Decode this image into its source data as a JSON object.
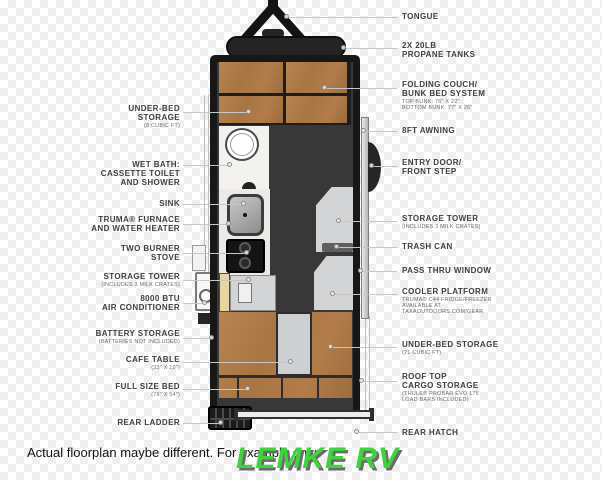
{
  "title": "travel trailer floorplan diagram",
  "colors": {
    "wood": "#b27c4a",
    "body_wall": "#171717",
    "interior_floor": "#383838",
    "fixture_gray": "#d2d4d6",
    "counter_white": "#ebeae7",
    "battery_box_beige": "#e6d5a0",
    "leader_line": "#c6c6c6",
    "label_text": "#3f3f3f",
    "brand_green": "#3fd33f",
    "checker_gray": "#efefef"
  },
  "labels_left": [
    {
      "text": "UNDER-BED\nSTORAGE",
      "sub": "(8 CUBIC FT)"
    },
    {
      "text": "WET BATH:\nCASSETTE TOILET\nAND SHOWER"
    },
    {
      "text": "SINK"
    },
    {
      "text": "TRUMA® FURNACE\nAND WATER HEATER"
    },
    {
      "text": "TWO BURNER\nSTOVE"
    },
    {
      "text": "STORAGE TOWER",
      "sub": "(INCLUDES 3 MILK CRATES)"
    },
    {
      "text": "8000 BTU\nAIR CONDITIONER"
    },
    {
      "text": "BATTERY STORAGE",
      "sub": "(BATTERIES NOT INCLUDED)"
    },
    {
      "text": "CAFE TABLE",
      "sub": "(33\" X 19\")"
    },
    {
      "text": "FULL SIZE BED",
      "sub": "(78\" X 54\")"
    },
    {
      "text": "REAR LADDER"
    }
  ],
  "labels_right": [
    {
      "text": "TONGUE"
    },
    {
      "text": "2X 20LB\nPROPANE TANKS"
    },
    {
      "text": "FOLDING COUCH/\nBUNK BED SYSTEM",
      "sub": "TOP BUNK: 76\" X 22\"\nBOTTOM BUNK: 77\" X 26\""
    },
    {
      "text": "8FT AWNING"
    },
    {
      "text": "ENTRY DOOR/\nFRONT STEP"
    },
    {
      "text": "STORAGE TOWER",
      "sub": "(INCLUDES 3 MILK CRATES)"
    },
    {
      "text": "TRASH CAN"
    },
    {
      "text": "PASS THRU WINDOW"
    },
    {
      "text": "COOLER PLATFORM",
      "sub": "TRUMA® C44 FRIDGE/FREEZER\nAVAILABLE AT\nTAXAOUTDOORS.COM/GEAR"
    },
    {
      "text": "UNDER-BED STORAGE",
      "sub": "(21 CUBIC FT)"
    },
    {
      "text": "ROOF TOP\nCARGO STORAGE",
      "sub": "(THULE® PROBAR EVO 175\nLOAD BARS INCLUDED)"
    },
    {
      "text": "REAR HATCH"
    }
  ],
  "footer": {
    "disclaimer": "Actual floorplan maybe different. For example only",
    "brand": "LEMKE RV"
  }
}
